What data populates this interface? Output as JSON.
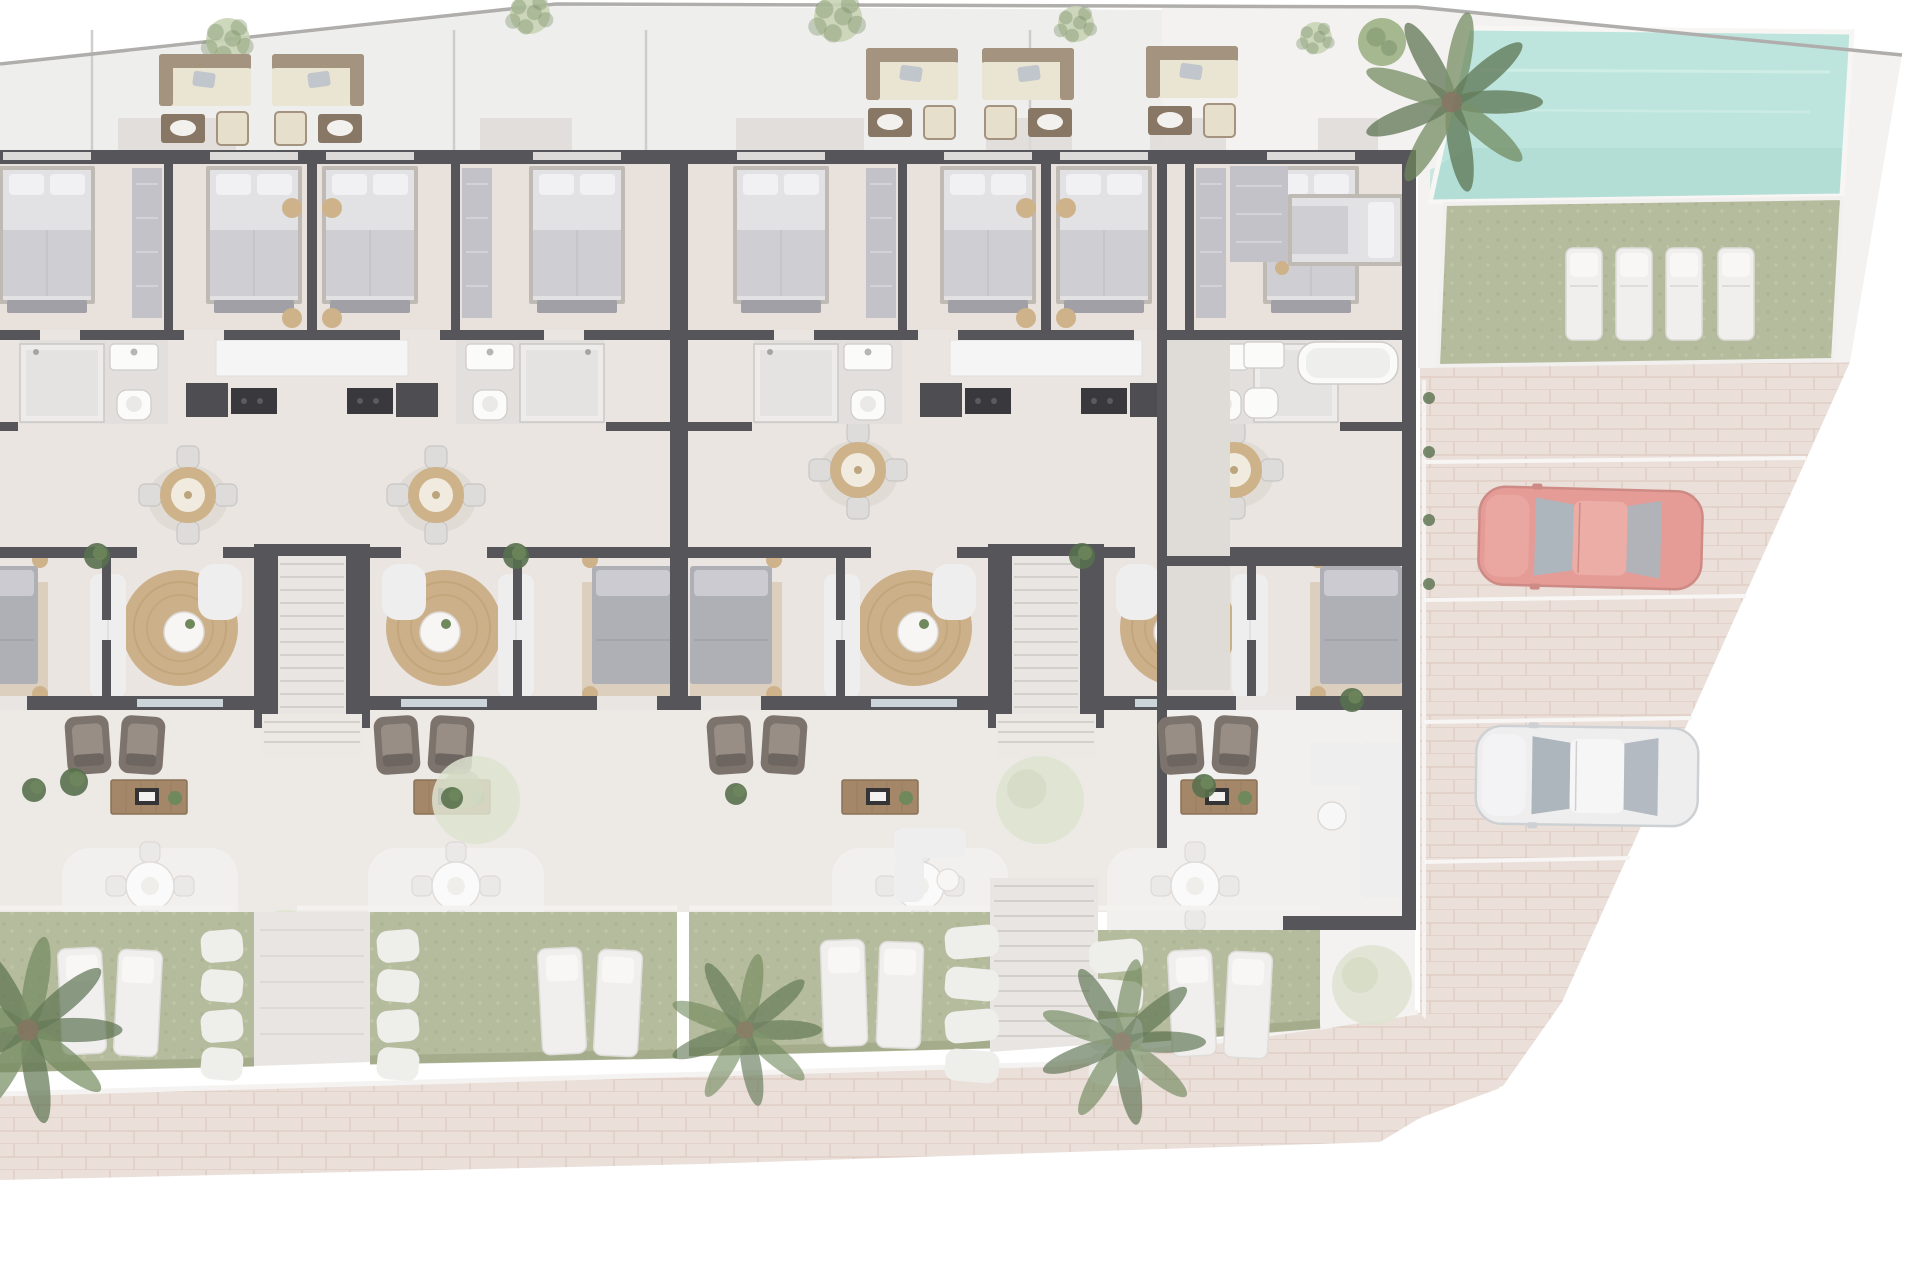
{
  "meta": {
    "type": "architectural-site-plan",
    "view": "top-down",
    "units_visible": 4,
    "floors_shown": "ground + faded roof terraces"
  },
  "palette": {
    "page": "#ffffff",
    "roofFloor": "#edecea",
    "roofLine": "#a6a5a3",
    "deck": "#f3f1ef",
    "floor": "#e9e3df",
    "floorWarm": "#e7dfd9",
    "bathFloor": "#e0dcd9",
    "hallFloor": "#dcd8d4",
    "wall": "#434248",
    "glassWin": "#d8d7d5",
    "glassDoor": "#c7d1d5",
    "shadow": "#d9d7d5",
    "bedSheet": "#dfdfe2",
    "bedBlanket": "#c9c9ce",
    "bedFrame": "#b9b3ad",
    "bedPillow": "#f0f0f2",
    "bench": "#97969e",
    "bed2": "#a6a6ae",
    "bed2Pillow": "#c6c6cc",
    "bedRug": "#d8cab6",
    "wardrobe": "#bcbcc2",
    "counter": "#f4f4f4",
    "cooktop": "#232327",
    "darkUnit": "#3a3a3f",
    "tableWood": "#c9aa7d",
    "tableWoodIn": "#efe8dc",
    "chairGray": "#dad9d7",
    "rug": "#c7a87c",
    "rugRing": "#b2905f",
    "coffeeTable": "#f6f5f4",
    "sofaWhite": "#ededec",
    "sofaLine": "#d9d7d4",
    "armchair": "#6f645d",
    "armchairIn": "#8d8279",
    "armchairDark": "#5d544e",
    "console": "#9a7a58",
    "consoleDark": "#7d6345",
    "loungeSeat": "#e8e1cd",
    "loungeBack": "#9a8770",
    "loungeTable": "#7c6854",
    "loungeChair": "#e4dcc6",
    "loungePillow": "#b9c0c6",
    "plant": "#5f7b4a",
    "plantDark": "#46603a",
    "paleTree": "#dbe0cb",
    "bushLight": "#c3cfae",
    "treeRound": "#9cb083",
    "lawn": "#adb492",
    "lawnDark": "#98a17c",
    "lawnDot1": "#a2ab85",
    "lawnDot2": "#b8bf9d",
    "poolWater": "#b7e3da",
    "poolDeep": "#a2d5cb",
    "poolEdge": "#f6f5f3",
    "paver": "#e8dcd5",
    "paverLine": "#dcc9bf",
    "stone": "#edece9",
    "pathLight": "#e6e3df",
    "stepLine": "#cfcbc7",
    "carRedBody": "#e2918b",
    "carRedDark": "#c97d77",
    "carRedRoof": "#eba49e",
    "carWhiteBody": "#ececee",
    "carWhiteDark": "#c9cccf",
    "carWhiteRoof": "#f5f5f7",
    "carGlass": "#a4adb6",
    "lounger": "#efeeec",
    "loungerEdge": "#dbd8d4",
    "loungerPillow": "#f8f7f5",
    "parapet": "#f3f1ee",
    "overlay": "rgba(255,255,255,0.10)"
  },
  "roof": {
    "band": [
      [
        0,
        66
      ],
      [
        556,
        6
      ],
      [
        1162,
        10
      ],
      [
        1162,
        150
      ],
      [
        0,
        150
      ]
    ],
    "boundary": [
      [
        0,
        64
      ],
      [
        556,
        4
      ],
      [
        1417,
        7
      ],
      [
        1902,
        55
      ]
    ],
    "dividers": [
      92,
      454,
      646,
      1030
    ],
    "shadows": [
      [
        118,
        118
      ],
      [
        480,
        92
      ],
      [
        736,
        128
      ],
      [
        986,
        86
      ],
      [
        1150,
        76
      ],
      [
        1318,
        60
      ]
    ],
    "trees": [
      [
        228,
        40,
        22
      ],
      [
        530,
        14,
        20
      ],
      [
        838,
        18,
        24
      ],
      [
        1076,
        24,
        18
      ],
      [
        1316,
        38,
        16
      ]
    ],
    "round_trees": [
      [
        1382,
        42,
        24
      ]
    ],
    "lounge_sets": [
      [
        205,
        54,
        1
      ],
      [
        318,
        54,
        -1
      ],
      [
        912,
        48,
        1
      ],
      [
        1028,
        48,
        -1
      ],
      [
        1192,
        46,
        1
      ]
    ]
  },
  "building": {
    "x": 0,
    "w": 1415,
    "interior_top": 150,
    "interior_bottom": 710,
    "terrace_bottom": 912,
    "pairs": [
      312,
      1046
    ],
    "top_bed_offsets": [
      -265,
      -58,
      58,
      265
    ],
    "pouf_offsets": [
      -20,
      20
    ],
    "bed2_walls": [
      {
        "x": -52,
        "sides": [
          1
        ]
      },
      {
        "x": 682,
        "sides": [
          -1,
          1
        ]
      },
      {
        "x": 1410,
        "sides": [
          -1
        ]
      }
    ],
    "dining": [
      [
        188,
        495
      ],
      [
        436,
        495
      ],
      [
        858,
        470
      ],
      [
        1234,
        470
      ]
    ],
    "armchairs": [
      115,
      424,
      757,
      1208
    ],
    "consoles": [
      149,
      452,
      880,
      1219
    ],
    "patios": [
      150,
      456,
      920,
      1195
    ],
    "terrace_sofas": [
      930
    ],
    "pale_trees": [
      [
        476,
        800,
        44
      ],
      [
        286,
        948,
        38
      ],
      [
        1040,
        800,
        44
      ],
      [
        1372,
        985,
        40
      ]
    ],
    "plants": [
      [
        97,
        556,
        13
      ],
      [
        516,
        556,
        13
      ],
      [
        1082,
        556,
        13
      ],
      [
        34,
        790,
        12
      ],
      [
        74,
        782,
        14
      ],
      [
        452,
        798,
        11
      ],
      [
        736,
        794,
        11
      ],
      [
        1204,
        786,
        12
      ],
      [
        1352,
        700,
        12
      ]
    ]
  },
  "right_section": {
    "wall_x": 1402,
    "bottom_wall_y": 916,
    "hall": [
      1162,
      340,
      68,
      350
    ],
    "terrace": [
      1162,
      710,
      240,
      206
    ],
    "wardrobe": [
      1230,
      166,
      58,
      96
    ],
    "bed_top": [
      1288,
      194
    ],
    "bath": [
      1244,
      342
    ],
    "sofa": [
      1360,
      742
    ],
    "side_table": [
      1332,
      816
    ],
    "strip": [
      [
        1320,
        930
      ],
      [
        1415,
        930
      ],
      [
        1415,
        1012
      ],
      [
        1320,
        1030
      ]
    ]
  },
  "pool": {
    "deck": [
      [
        1162,
        8
      ],
      [
        1417,
        5
      ],
      [
        1902,
        55
      ],
      [
        1850,
        362
      ],
      [
        1418,
        368
      ],
      [
        1418,
        166
      ],
      [
        1162,
        152
      ]
    ],
    "water": [
      [
        1468,
        28
      ],
      [
        1852,
        32
      ],
      [
        1842,
        196
      ],
      [
        1430,
        202
      ]
    ],
    "deep": [
      [
        1468,
        148
      ],
      [
        1842,
        148
      ],
      [
        1842,
        196
      ],
      [
        1430,
        202
      ],
      [
        1430,
        170
      ]
    ]
  },
  "lawn": {
    "area": [
      [
        1445,
        204
      ],
      [
        1842,
        198
      ],
      [
        1833,
        360
      ],
      [
        1438,
        366
      ]
    ],
    "loungers": [
      1566,
      1616,
      1666,
      1718
    ],
    "lounger_y": 248
  },
  "parking": {
    "area": [
      [
        1420,
        368
      ],
      [
        1850,
        362
      ],
      [
        1562,
        1002
      ],
      [
        1503,
        1086
      ],
      [
        1420,
        1108
      ]
    ],
    "stall_lines": [
      [
        1424,
        462,
        1806,
        458
      ],
      [
        1424,
        600,
        1746,
        596
      ],
      [
        1424,
        722,
        1692,
        718
      ],
      [
        1424,
        862,
        1630,
        858
      ]
    ],
    "left_line_x": 1424,
    "cars": [
      {
        "x": 1479,
        "y": 489,
        "w": 223,
        "h": 98,
        "color": "red",
        "rot": 1.5
      },
      {
        "x": 1476,
        "y": 727,
        "w": 222,
        "h": 98,
        "color": "white",
        "rot": 0.8
      }
    ],
    "planters": [
      [
        1429,
        398
      ],
      [
        1429,
        452
      ],
      [
        1429,
        520
      ],
      [
        1429,
        584
      ]
    ]
  },
  "gardens": {
    "blocks": [
      [
        [
          0,
          912
        ],
        [
          254,
          912
        ],
        [
          254,
          1066
        ],
        [
          0,
          1072
        ]
      ],
      [
        [
          370,
          912
        ],
        [
          677,
          912
        ],
        [
          677,
          1058
        ],
        [
          370,
          1064
        ]
      ],
      [
        [
          689,
          912
        ],
        [
          990,
          912
        ],
        [
          990,
          1048
        ],
        [
          689,
          1056
        ]
      ],
      [
        [
          1098,
          930
        ],
        [
          1320,
          930
        ],
        [
          1320,
          1028
        ],
        [
          1098,
          1046
        ]
      ]
    ],
    "loungers": [
      [
        60,
        948,
        -3
      ],
      [
        116,
        950,
        3
      ],
      [
        540,
        948,
        -3
      ],
      [
        596,
        950,
        3
      ],
      [
        822,
        940,
        -2
      ],
      [
        878,
        942,
        2
      ],
      [
        1170,
        950,
        -3
      ],
      [
        1226,
        952,
        3
      ]
    ],
    "stone_cols": [
      {
        "x": 222,
        "w": 42,
        "rows": [
          930,
          970,
          1010,
          1048
        ]
      },
      {
        "x": 398,
        "w": 42,
        "rows": [
          930,
          970,
          1010,
          1048
        ]
      },
      {
        "x": 972,
        "w": 54,
        "rows": [
          926,
          968,
          1010,
          1050
        ]
      },
      {
        "x": 1116,
        "w": 54,
        "rows": [
          940,
          980,
          1018,
          1054
        ]
      }
    ],
    "path1": [
      [
        254,
        912
      ],
      [
        370,
        912
      ],
      [
        370,
        1062
      ],
      [
        254,
        1066
      ]
    ],
    "path2": [
      [
        990,
        878
      ],
      [
        1098,
        878
      ],
      [
        1098,
        1044
      ],
      [
        990,
        1052
      ]
    ],
    "parapet_segments": [
      [
        0,
        233
      ],
      [
        297,
        677
      ],
      [
        689,
        990
      ],
      [
        1098,
        1320
      ]
    ],
    "parapet_y": 908
  },
  "walkway": {
    "area": [
      [
        0,
        1094
      ],
      [
        1062,
        1064
      ],
      [
        1418,
        1012
      ],
      [
        1500,
        1088
      ],
      [
        1420,
        1118
      ],
      [
        1380,
        1142
      ],
      [
        700,
        1164
      ],
      [
        0,
        1180
      ]
    ]
  },
  "palms": [
    [
      28,
      1030,
      1.35,
      0.85
    ],
    [
      745,
      1030,
      1.1,
      0.75
    ],
    [
      1122,
      1042,
      1.2,
      0.8
    ],
    [
      1452,
      102,
      1.3,
      0.9
    ]
  ]
}
